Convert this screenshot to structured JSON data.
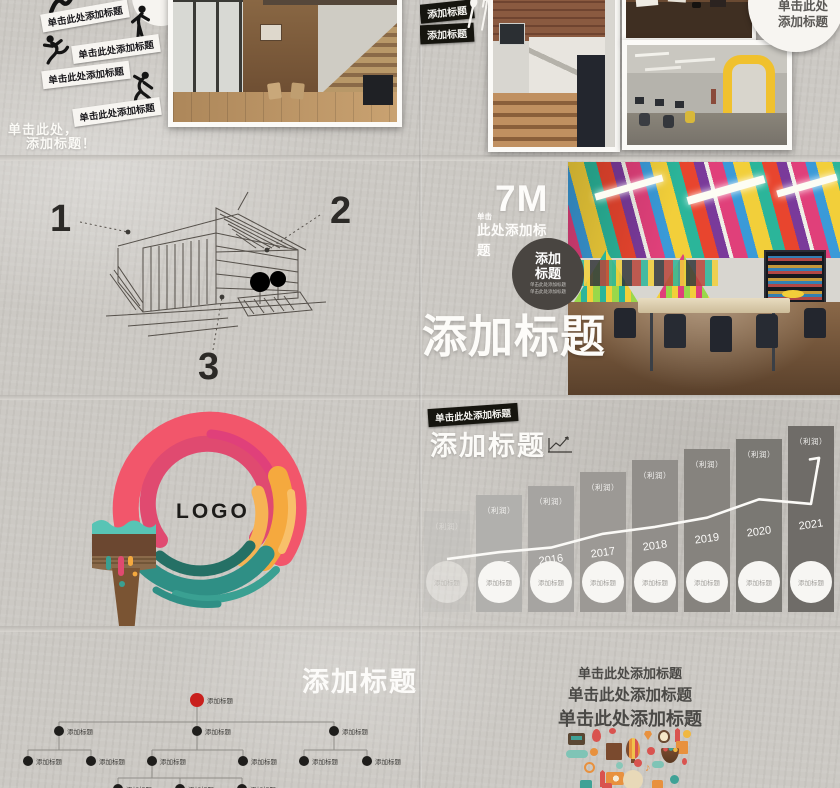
{
  "palette": {
    "concrete": "#ccc9c4",
    "tag_black": "#16150f",
    "accent_red": "#c9201d",
    "swirl_pink": "#f2566b",
    "swirl_orange": "#f5a93e",
    "swirl_teal": "#2f8f85",
    "yellow_arch": "#f0c12e"
  },
  "row1_left": {
    "strips": [
      "单击此处添加标题",
      "单击此处添加标题",
      "单击此处添加标题",
      "单击此处添加标题"
    ],
    "caption_line1": "单击此处，",
    "caption_line2": "添加标题！"
  },
  "row1_right": {
    "tags": [
      "添加标题",
      "添加标题"
    ],
    "circle_line1": "单击此处",
    "circle_line2": "添加标题"
  },
  "row2_left": {
    "markers": [
      "1",
      "2",
      "3"
    ]
  },
  "row2_right": {
    "big_number": "7M",
    "pre_label": "单击",
    "sub_label": "此处添加标题",
    "badge_line1": "添加",
    "badge_line2": "标题",
    "badge_small1": "单击此处添加标题",
    "badge_small2": "单击此处添加标题",
    "title": "添加标题"
  },
  "row3_left": {
    "logo": "LOGO"
  },
  "row4_left": {
    "title": "添加标题",
    "node_label": "添加标题"
  },
  "row4_right": {
    "lines": [
      "单击此处添加标题",
      "单击此处添加标题",
      "单击此处添加标题"
    ]
  },
  "chart_data": {
    "type": "bar",
    "title": "添加标题",
    "corner_tag": "单击此处添加标题",
    "categories": [
      "2014",
      "2015",
      "2016",
      "2017",
      "2018",
      "2019",
      "2020",
      "2021"
    ],
    "values": [
      44,
      51,
      55,
      61,
      66,
      71,
      75,
      81
    ],
    "bar_value_label": "（利润）",
    "bar_footer_label": "添加标题",
    "overlay_line": {
      "values": [
        23,
        26,
        28,
        34,
        37,
        41,
        49,
        47
      ],
      "arrow_end_value": 67
    },
    "ylim": [
      0,
      100
    ],
    "xlabel": "",
    "ylabel": ""
  }
}
